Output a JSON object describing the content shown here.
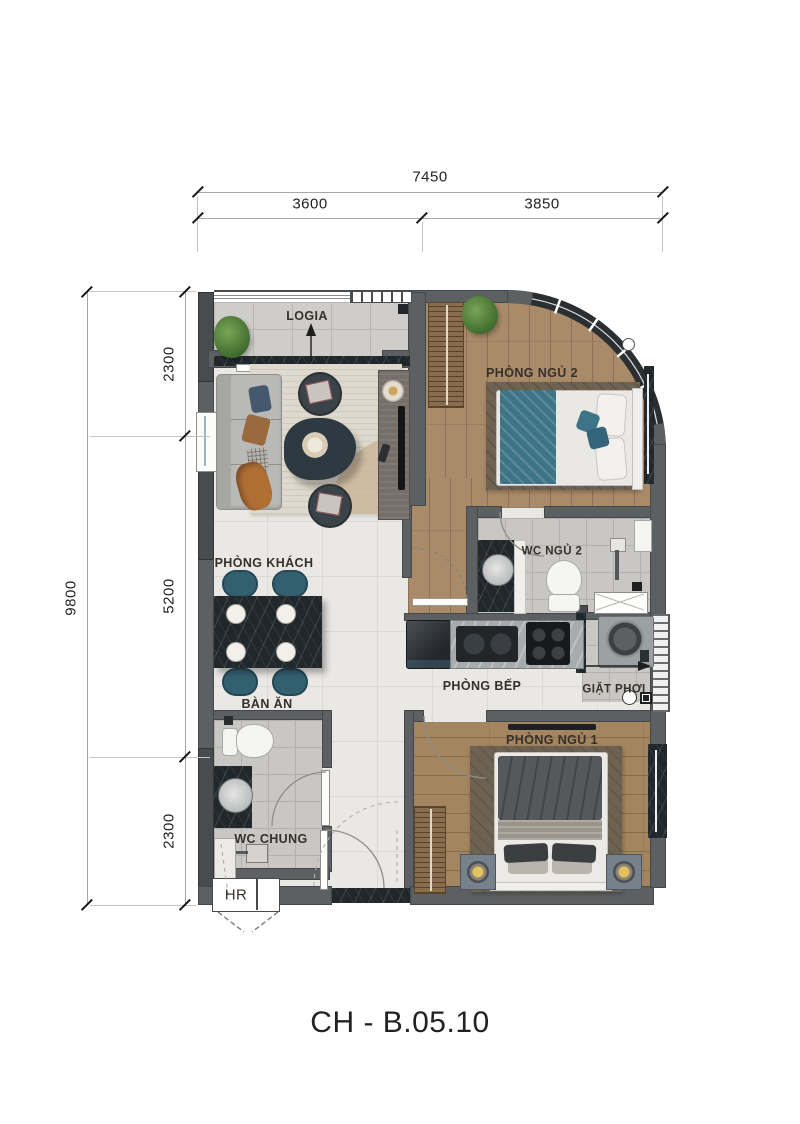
{
  "sheet": {
    "title": "CH - B.05.10"
  },
  "palette": {
    "wall": "#5d6063",
    "wall-dark": "#494c4e",
    "wood": "#a98b69",
    "tile-light": "#eae8e4",
    "tile-gray": "#cfcdc9",
    "tile-bath": "#c9c7c3",
    "marble-dark": "#20282c",
    "teal": "#3e7487",
    "teal-dark": "#33606f",
    "rug-living": "#ded9cd",
    "rug-bedroom": "#6e6253",
    "sofa-gray": "#b9b9b7",
    "bed1-blanket": "#55595b",
    "metal-gray": "#9ba0a3",
    "plant-green": "#4e7d3a",
    "dim-text": "#222222",
    "label-text": "#35302a"
  },
  "dimensions": {
    "top": {
      "total": "7450",
      "segments": [
        {
          "label": "3600"
        },
        {
          "label": "3850"
        }
      ]
    },
    "left": {
      "total": "9800",
      "segments": [
        {
          "label": "2300"
        },
        {
          "label": "5200"
        },
        {
          "label": "2300"
        }
      ]
    }
  },
  "rooms": {
    "logia": {
      "label": "LOGIA"
    },
    "living": {
      "label": "PHÒNG KHÁCH"
    },
    "bedroom2": {
      "label": "PHÒNG NGỦ 2"
    },
    "wc_bedroom2": {
      "label": "WC NGỦ 2"
    },
    "kitchen": {
      "label": "PHÒNG BẾP"
    },
    "laundry": {
      "label": "GIẶT PHƠI"
    },
    "dining": {
      "label": "BÀN ĂN"
    },
    "wc_shared": {
      "label": "WC CHUNG"
    },
    "bedroom1": {
      "label": "PHÒNG NGỦ 1"
    },
    "riser": {
      "label": "HR"
    }
  }
}
